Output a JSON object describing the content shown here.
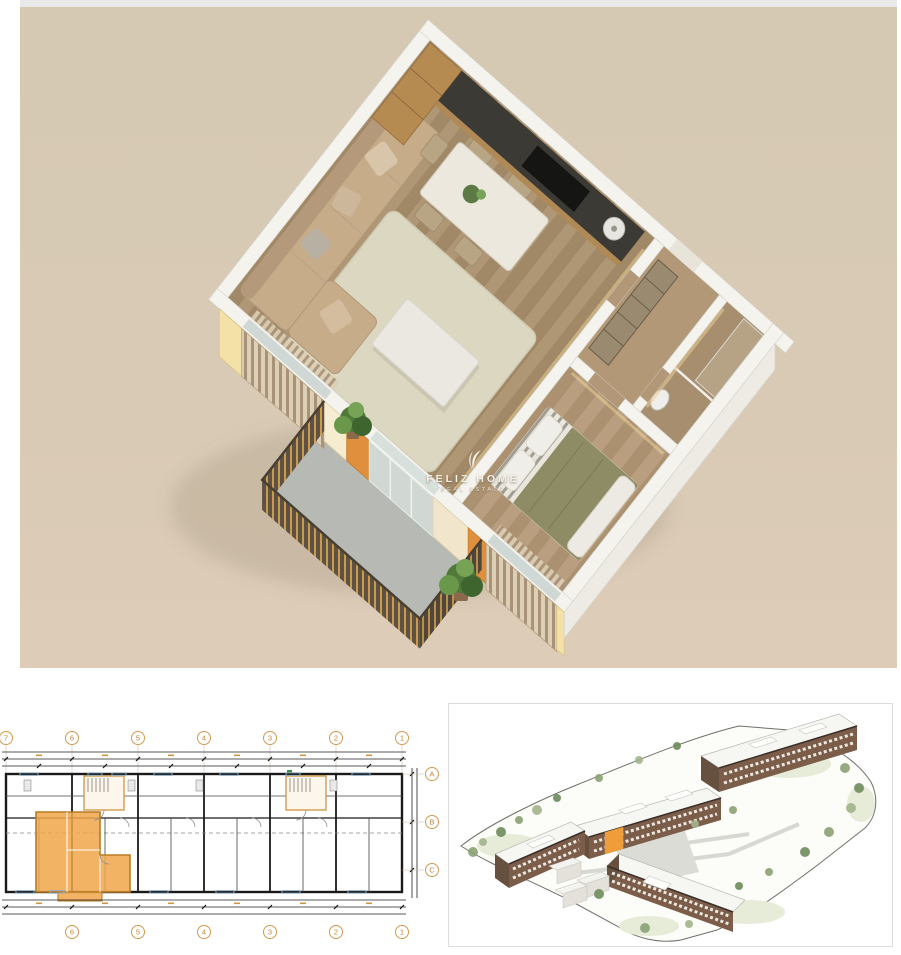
{
  "page": {
    "background": "#ffffff"
  },
  "hero": {
    "top_strip_color": "#eae9e9",
    "background_color": "#d6c9b3",
    "subject": "3d-isometric-one-bedroom-apartment-render",
    "rooms": [
      "living-dining-kitchen",
      "hallway",
      "bathroom",
      "bedroom",
      "balcony"
    ],
    "accent_colors": {
      "exterior_cream": "#f3e1a8",
      "accent_orange": "#e08f3c",
      "wood_floor": "#a8906e",
      "balcony_floor": "#b7bab4",
      "railing_brown": "#5f5244",
      "railing_gold": "#c79c4c"
    }
  },
  "watermark": {
    "brand": "FELIZ HOME",
    "tagline": "REAL ESTATE"
  },
  "plan2d": {
    "grid_top_labels": [
      "7",
      "6",
      "5",
      "4",
      "3",
      "2",
      "1"
    ],
    "grid_bottom_labels": [
      "6",
      "5",
      "4",
      "3",
      "2",
      "1"
    ],
    "grid_right_labels": [
      "A",
      "B",
      "C"
    ],
    "highlight_color": "#f0a64a",
    "stair_core_color": "#cf9440"
  },
  "siteplan": {
    "highlight_color": "#ef9d3b",
    "building_facade_color": "#7c5d4a",
    "roof_color": "#f6f6f2"
  }
}
